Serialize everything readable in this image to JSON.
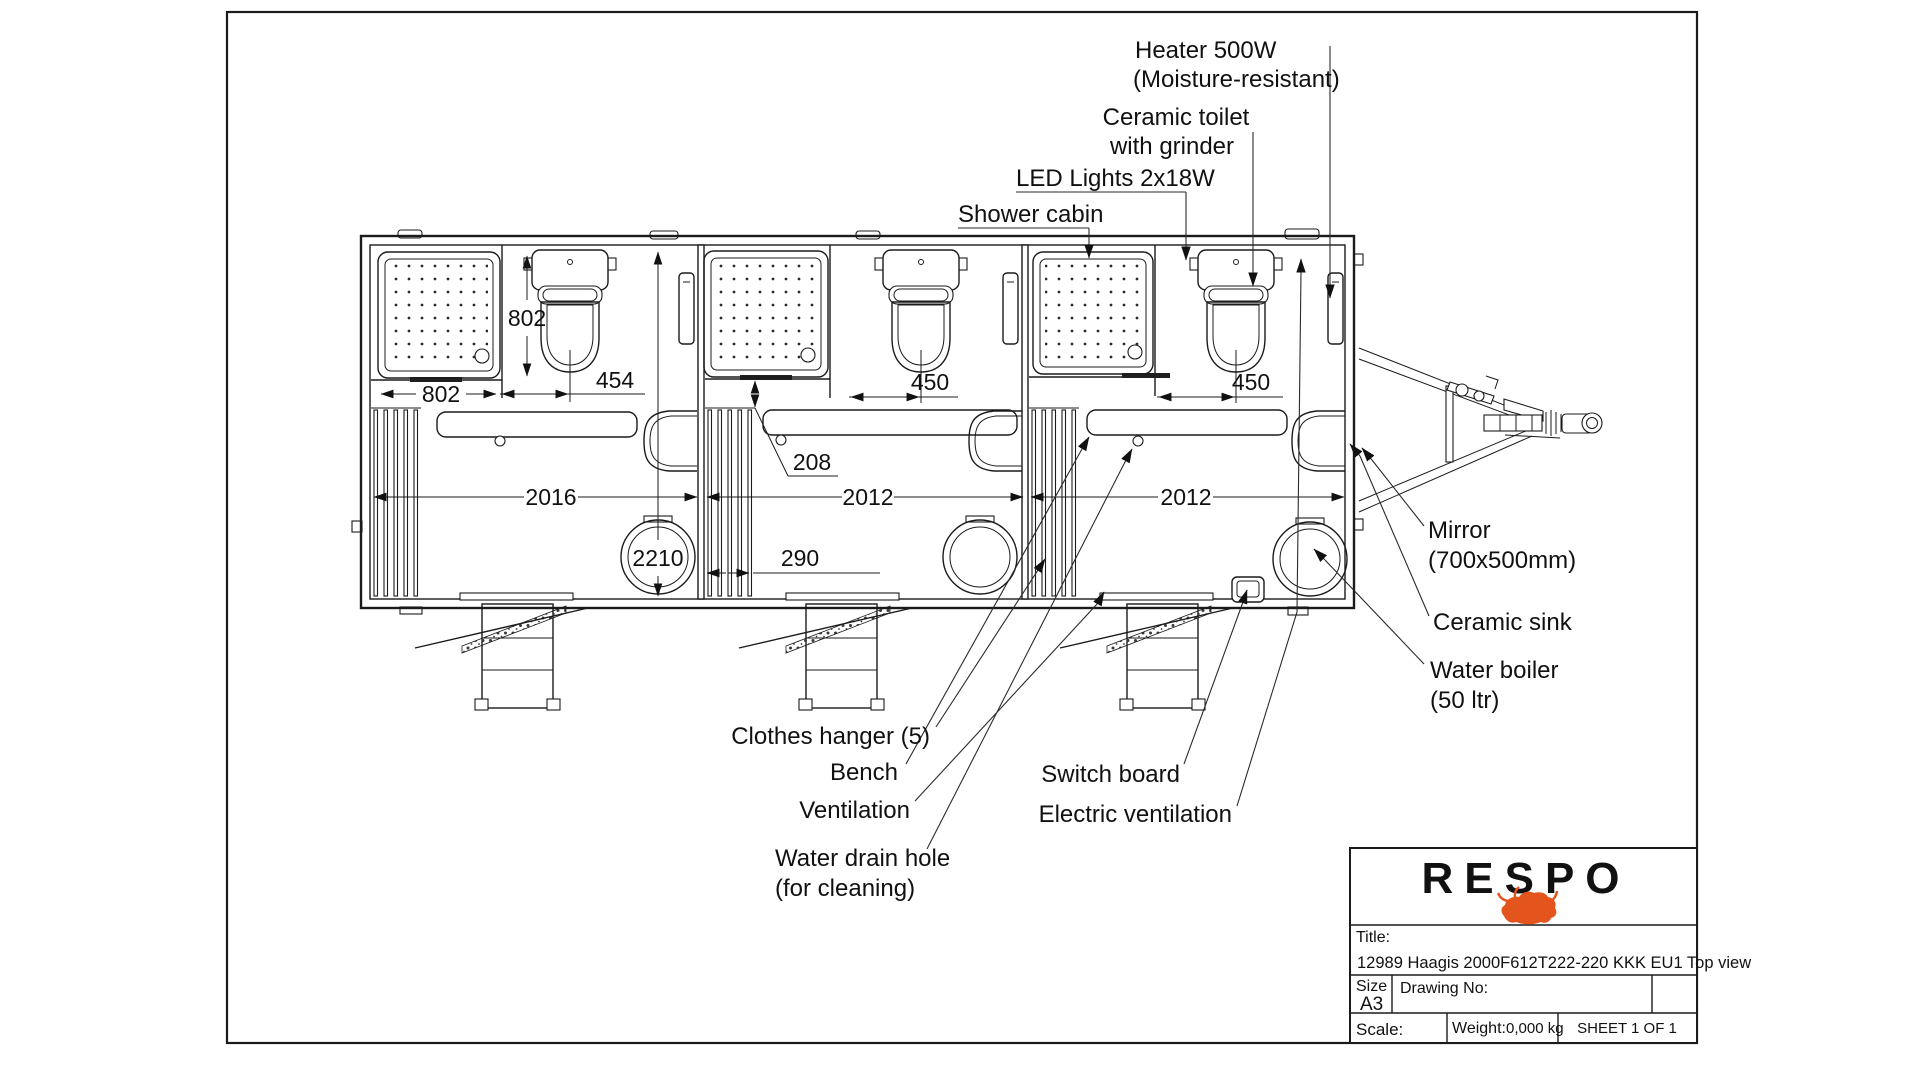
{
  "callouts": {
    "heater1": "Heater 500W",
    "heater2": "(Moisture-resistant)",
    "toilet1": "Ceramic toilet",
    "toilet2": "with grinder",
    "led": "LED Lights 2x18W",
    "shower": "Shower cabin",
    "mirror1": "Mirror",
    "mirror2": "(700x500mm)",
    "sink": "Ceramic sink",
    "boiler1": "Water boiler",
    "boiler2": "(50 ltr)",
    "hanger": "Clothes hanger (5)",
    "bench": "Bench",
    "ventilation": "Ventilation",
    "drain1": "Water drain hole",
    "drain2": "(for cleaning)",
    "switchboard": "Switch board",
    "eventilation": "Electric ventilation"
  },
  "dims": {
    "tray_depth": "802",
    "tray_width": "802",
    "toilet_offset_room1": "454",
    "toilet_offset_room2": "450",
    "toilet_offset_room3": "450",
    "tray_bench_gap": "208",
    "room1_length": "2016",
    "room2_length": "2012",
    "room3_length": "2012",
    "interior_width": "2210",
    "hanger_width": "290"
  },
  "block": {
    "brand": "RESPO",
    "title_label": "Title:",
    "title_value": "12989 Haagis 2000F612T222-220 KKK EU1 Top view",
    "size_label": "Size",
    "size_value": "A3",
    "drawing_label": "Drawing No:",
    "scale_label": "Scale:",
    "weight_label": "Weight:",
    "weight_value": "0,000 kg",
    "sheet": "SHEET 1 OF 1"
  },
  "colors": {
    "brand": "#E4551E",
    "ink": "#1b1b1b"
  }
}
